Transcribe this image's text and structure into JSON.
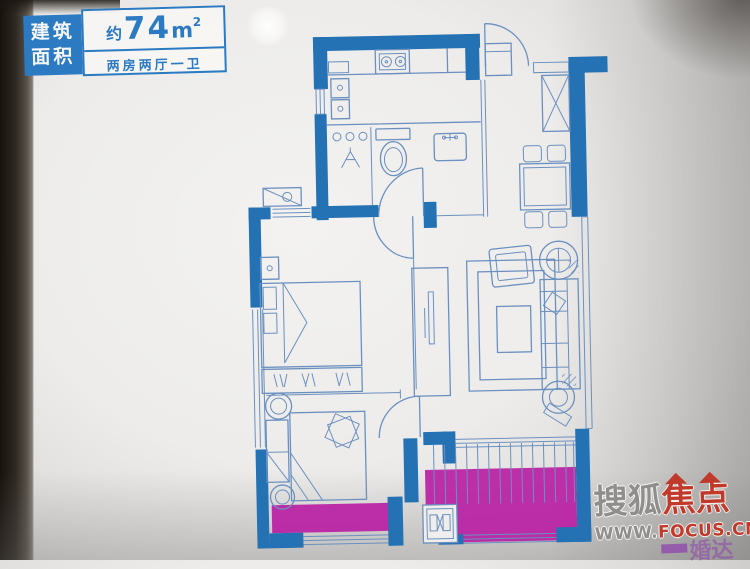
{
  "area_label": {
    "title_line1": "建筑",
    "title_line2": "面积",
    "approx_prefix": "约",
    "area_value": "74",
    "area_unit": "m",
    "area_exponent": "2",
    "layout_type": "两房两厅一卫"
  },
  "watermark": {
    "brand_first": "搜狐",
    "brand_second": "焦点",
    "url_prefix": "WWW.",
    "url_suffix": "FOCUS.CN",
    "secondary_text": "婚达"
  },
  "colors": {
    "wall-blue": "#2471b3",
    "line-blue": "#6b90c0",
    "highlight-magenta": "#b81fa4",
    "label-blue": "#2b7ac2",
    "watermark-gray": "#8f8e8c",
    "watermark-red": "#c0392b",
    "watermark-purple": "#8e44ad",
    "paper": "#efeeec"
  }
}
